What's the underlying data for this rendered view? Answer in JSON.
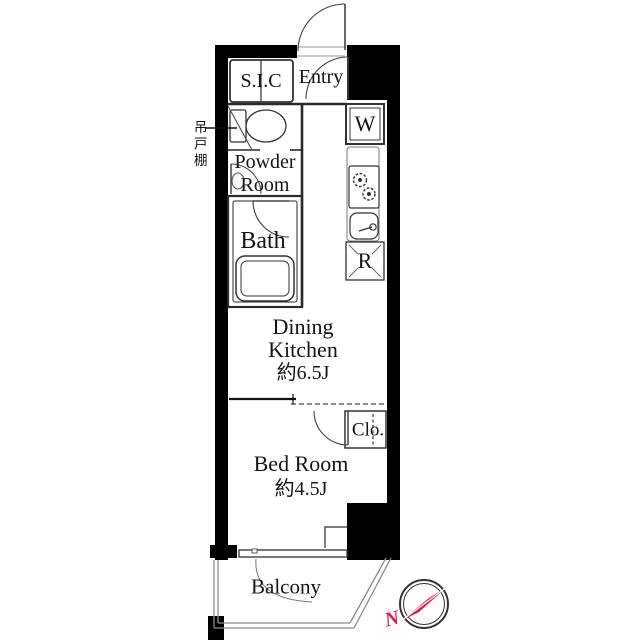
{
  "plan": {
    "rooms": {
      "sic": "S.I.C",
      "entry": "Entry",
      "powder_line1": "Powder",
      "powder_line2": "Room",
      "bath": "Bath",
      "dk_line1": "Dining",
      "dk_line2": "Kitchen",
      "dk_size": "約6.5J",
      "closet": "Clo.",
      "bedroom": "Bed Room",
      "bedroom_size": "約4.5J",
      "balcony": "Balcony"
    },
    "appliances": {
      "washer": "W",
      "fridge": "R"
    },
    "annotations": {
      "hanging_cupboard": "吊戸棚",
      "compass_north": "N"
    },
    "colors": {
      "wall": "#000000",
      "interior_line": "#333333",
      "light_line": "#888888",
      "accent_red": "#e0164e"
    }
  }
}
